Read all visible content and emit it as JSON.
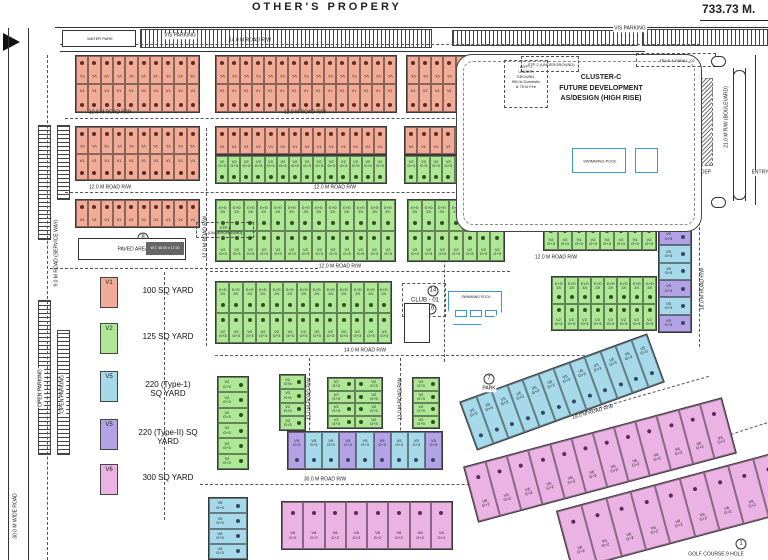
{
  "page": {
    "title": "OTHER'S PROPERY",
    "dimension": "733.73 M.",
    "water_park": "WATER PARK"
  },
  "legend": {
    "entries": [
      {
        "code": "V1",
        "color": "v1",
        "label": "100 SQ YARD"
      },
      {
        "code": "V2",
        "color": "v2",
        "label": "125 SQ YARD"
      },
      {
        "code": "V5",
        "color": "v5",
        "label": "220 (Type-1)|SQ YARD"
      },
      {
        "code": "V5",
        "color": "v5b",
        "label": "220 (Type-II) SQ|YARD"
      },
      {
        "code": "V6",
        "color": "v6",
        "label": "300 SQ YARD"
      }
    ]
  },
  "cluster_c": {
    "l1": "CLUSTER-C",
    "l2": "FUTURE DEVELOPMENT",
    "l3": "AS/DESIGN (HIGH RISE)",
    "stp2": "STP-2 (UNDERGROUND)",
    "trus": "TRUS & PANEL -02",
    "pool": "SWIMMING POOL"
  },
  "wtp1": {
    "l1": "WTP-1",
    "l2": "UNDER-",
    "l3": "GROUND,",
    "l4": "900 kl Domestic",
    "l5": "& 75 kl Fire"
  },
  "club": {
    "label": "CLUB - 01",
    "pool": "SWIMMING POOL"
  },
  "paved": {
    "label": "PAVED AREA",
    "stp1_l1": "STP-1",
    "stp1_l2": "(UNDERGROUND)",
    "tank_dim": "W.T. 48.00 x 17.00"
  },
  "colors": {
    "v1": "#f2ab97",
    "v2": "#aee795",
    "v5": "#a6d9e9",
    "v5b": "#b3a3e6",
    "v6": "#eab3e3",
    "dot_v1": "#5e2a22",
    "dot_v2": "#33511f",
    "dot_v5": "#35485c",
    "dot_v5b": "#43335e",
    "dot_v6": "#5c2c52",
    "line": "#333333",
    "pool": "#3f97c6"
  },
  "blocks": [
    {
      "x": 75,
      "y": 55,
      "w": 125,
      "h": 58,
      "c": "v1",
      "r": 2,
      "n": 10,
      "t": "V1",
      "d": "outer"
    },
    {
      "x": 215,
      "y": 55,
      "w": 182,
      "h": 58,
      "c": "v1",
      "r": 2,
      "n": 15,
      "t": "V1",
      "d": "outer"
    },
    {
      "x": 406,
      "y": 55,
      "w": 99,
      "h": 58,
      "c": "v1",
      "r": 2,
      "n": 8,
      "t": "V1",
      "d": "outer"
    },
    {
      "x": 75,
      "y": 126,
      "w": 125,
      "h": 55,
      "c": "v1",
      "r": 2,
      "n": 10,
      "t": "V1",
      "d": "outer"
    },
    {
      "x": 215,
      "y": 126,
      "w": 172,
      "h": 29,
      "c": "v1",
      "r": 1,
      "n": 14,
      "t": "V1",
      "d": "top"
    },
    {
      "x": 215,
      "y": 155,
      "w": 172,
      "h": 29,
      "c": "v2",
      "r": 1,
      "n": 14,
      "t": "V2 G+3",
      "d": "bottom"
    },
    {
      "x": 404,
      "y": 126,
      "w": 101,
      "h": 29,
      "c": "v1",
      "r": 1,
      "n": 8,
      "t": "V1",
      "d": "top"
    },
    {
      "x": 404,
      "y": 155,
      "w": 101,
      "h": 29,
      "c": "v2",
      "r": 1,
      "n": 8,
      "t": "V2 G+3",
      "d": "bottom"
    },
    {
      "x": 75,
      "y": 199,
      "w": 125,
      "h": 29,
      "c": "v1",
      "r": 1,
      "n": 10,
      "t": "V1",
      "d": "top"
    },
    {
      "x": 215,
      "y": 199,
      "w": 181,
      "h": 63,
      "c": "v2",
      "r": 2,
      "n": 13,
      "t": "V2 G+3",
      "d": "inner"
    },
    {
      "x": 407,
      "y": 199,
      "w": 98,
      "h": 63,
      "c": "v2",
      "r": 2,
      "n": 7,
      "t": "V2 G+3",
      "d": "inner"
    },
    {
      "x": 215,
      "y": 281,
      "w": 177,
      "h": 63,
      "c": "v2",
      "r": 2,
      "n": 13,
      "t": "V2 G+3",
      "d": "inner"
    },
    {
      "x": 543,
      "y": 224,
      "w": 114,
      "h": 27,
      "c": "v2",
      "r": 1,
      "n": 8,
      "t": "V2 G+3",
      "d": "top"
    },
    {
      "x": 551,
      "y": 276,
      "w": 106,
      "h": 55,
      "c": "v2",
      "r": 2,
      "n": 8,
      "t": "V2 G+3",
      "d": "inner"
    },
    {
      "x": 658,
      "y": 227,
      "w": 34,
      "h": 106,
      "c": "v5",
      "r": 6,
      "n": 1,
      "t": "V5 G+3",
      "d": "right",
      "cc": [
        "v5b",
        "v5",
        "v5",
        "v5b",
        "v5",
        "v5b"
      ]
    },
    {
      "x": 217,
      "y": 376,
      "w": 32,
      "h": 94,
      "c": "v2",
      "r": 6,
      "n": 1,
      "t": "V2 G+3",
      "d": "right"
    },
    {
      "x": 279,
      "y": 374,
      "w": 27,
      "h": 57,
      "c": "v2",
      "r": 4,
      "n": 1,
      "t": "V2 G+3",
      "d": "right"
    },
    {
      "x": 327,
      "y": 377,
      "w": 56,
      "h": 52,
      "c": "v2",
      "r": 4,
      "n": 2,
      "t": "V2 G+3",
      "d": "mid"
    },
    {
      "x": 412,
      "y": 377,
      "w": 28,
      "h": 52,
      "c": "v2",
      "r": 4,
      "n": 1,
      "t": "V2 G+3",
      "d": "right"
    },
    {
      "x": 287,
      "y": 431,
      "w": 156,
      "h": 39,
      "c": "v5",
      "r": 1,
      "n": 9,
      "t": "V5 G+3",
      "d": "bottom",
      "cc": [
        "v5b",
        "v5",
        "v5",
        "v5b",
        "v5",
        "v5b",
        "v5",
        "v5",
        "v5b"
      ]
    },
    {
      "x": 208,
      "y": 497,
      "w": 40,
      "h": 63,
      "c": "v5",
      "r": 4,
      "n": 1,
      "t": "V5 G+3",
      "d": "right"
    },
    {
      "x": 281,
      "y": 501,
      "w": 172,
      "h": 49,
      "c": "v6",
      "r": 1,
      "n": 8,
      "t": "V6 G+2",
      "d": "top"
    },
    {
      "x": 462,
      "y": 366,
      "w": 200,
      "h": 52,
      "c": "v5",
      "r": 1,
      "n": 12,
      "t": "V5 G+3",
      "d": "bottom",
      "rot": -20
    },
    {
      "x": 466,
      "y": 431,
      "w": 268,
      "h": 58,
      "c": "v6",
      "r": 1,
      "n": 12,
      "t": "V6 G+2",
      "d": "top",
      "rot": -15
    },
    {
      "x": 560,
      "y": 480,
      "w": 230,
      "h": 62,
      "c": "v6",
      "r": 1,
      "n": 9,
      "t": "V6 G+2",
      "d": "top",
      "rot": -15
    }
  ],
  "labels": [
    {
      "t": "14.0 M ROAD R/W",
      "x": 250,
      "y": 41,
      "rot": 0,
      "k": "road"
    },
    {
      "t": "12.0 M ROAD R/W",
      "x": 110,
      "y": 113,
      "rot": 0,
      "k": "road"
    },
    {
      "t": "12.0 M ROAD R/W",
      "x": 305,
      "y": 113,
      "rot": 0,
      "k": "road"
    },
    {
      "t": "12.0 M ROAD R/W",
      "x": 110,
      "y": 188,
      "rot": 0,
      "k": "road"
    },
    {
      "t": "12.0 M ROAD R/W",
      "x": 335,
      "y": 188,
      "rot": 0,
      "k": "road"
    },
    {
      "t": "12.0 M ROAD R/W",
      "x": 340,
      "y": 267,
      "rot": 0,
      "k": "road"
    },
    {
      "t": "14.0 M ROAD R/W",
      "x": 365,
      "y": 351,
      "rot": 0,
      "k": "road"
    },
    {
      "t": "16.0 M ROAD R/W",
      "x": 562,
      "y": 207,
      "rot": 0,
      "k": "road"
    },
    {
      "t": "12.0 M ROAD R/W",
      "x": 556,
      "y": 258,
      "rot": 0,
      "k": "road"
    },
    {
      "t": "30.0 M ROAD R/W",
      "x": 325,
      "y": 480,
      "rot": 0,
      "k": "road"
    },
    {
      "t": "12.0 M ROAD R/W",
      "x": 206,
      "y": 237,
      "rot": -90,
      "k": "road"
    },
    {
      "t": "12.0 M ROAD R/W",
      "x": 310,
      "y": 399,
      "rot": -90,
      "k": "road"
    },
    {
      "t": "12.0 M ROAD R/W",
      "x": 401,
      "y": 399,
      "rot": -90,
      "k": "road"
    },
    {
      "t": "18.0 M ROAD R/W",
      "x": 703,
      "y": 289,
      "rot": -90,
      "k": "road"
    },
    {
      "t": "18.0 M ROAD R/W",
      "x": 593,
      "y": 413,
      "rot": -16,
      "k": "road"
    },
    {
      "t": "9.0 M ROAD (SERVICE WAY)",
      "x": 57,
      "y": 253,
      "rot": -90,
      "k": "road"
    },
    {
      "t": "21.0 M R/W (BOULEVARD)",
      "x": 727,
      "y": 117,
      "rot": -90,
      "k": "road"
    },
    {
      "t": "OPEN PARKING",
      "x": 41,
      "y": 388,
      "rot": -90,
      "k": "area"
    },
    {
      "t": "OPEN PARKING",
      "x": 63,
      "y": 394,
      "rot": -90,
      "k": "area"
    },
    {
      "t": "30.0 M WIDE ROAD",
      "x": 16,
      "y": 516,
      "rot": -90,
      "k": "road"
    },
    {
      "t": "VIS PARKING",
      "x": 180,
      "y": 36,
      "rot": 0,
      "k": "area"
    },
    {
      "t": "VIS PARKING",
      "x": 630,
      "y": 29,
      "rot": 0,
      "k": "area"
    },
    {
      "t": "DEP",
      "x": 706,
      "y": 173,
      "rot": 0,
      "k": "area"
    },
    {
      "t": "ENTRY",
      "x": 760,
      "y": 173,
      "rot": 0,
      "k": "area"
    },
    {
      "t": "PARK",
      "x": 489,
      "y": 389,
      "rot": 0,
      "k": "area"
    },
    {
      "t": "GOLF COURSE 9 HOLE",
      "x": 716,
      "y": 555,
      "rot": 0,
      "k": "area"
    }
  ],
  "badges": [
    {
      "n": "8",
      "x": 143,
      "y": 238
    },
    {
      "n": "14",
      "x": 433,
      "y": 291
    },
    {
      "n": "16",
      "x": 431,
      "y": 309
    },
    {
      "n": "13",
      "x": 410,
      "y": 318
    },
    {
      "n": "7",
      "x": 489,
      "y": 379
    },
    {
      "n": "1",
      "x": 741,
      "y": 544
    }
  ],
  "dashes": [
    {
      "x": 60,
      "y": 44,
      "w": 640,
      "rot": 0
    },
    {
      "x": 65,
      "y": 118,
      "w": 445,
      "rot": 0
    },
    {
      "x": 65,
      "y": 192,
      "w": 445,
      "rot": 0
    },
    {
      "x": 210,
      "y": 271,
      "w": 300,
      "rot": 0
    },
    {
      "x": 215,
      "y": 355,
      "w": 430,
      "rot": 0
    },
    {
      "x": 200,
      "y": 484,
      "w": 340,
      "rot": 0
    },
    {
      "x": 207,
      "y": 128,
      "w": 218,
      "rot": 90
    },
    {
      "x": 310,
      "y": 358,
      "w": 112,
      "rot": 90
    },
    {
      "x": 401,
      "y": 358,
      "w": 112,
      "rot": 90
    },
    {
      "x": 445,
      "y": 200,
      "w": 162,
      "rot": 90
    },
    {
      "x": 700,
      "y": 212,
      "w": 135,
      "rot": 90
    },
    {
      "x": 48,
      "y": 55,
      "w": 505,
      "rot": 90
    },
    {
      "x": 50,
      "y": 268,
      "w": 268,
      "rot": 0
    },
    {
      "x": 165,
      "y": 272,
      "w": 248,
      "rot": 90
    },
    {
      "x": 478,
      "y": 442,
      "w": 240,
      "rot": -16
    },
    {
      "x": 585,
      "y": 520,
      "w": 225,
      "rot": -16
    },
    {
      "x": 620,
      "y": 470,
      "w": 200,
      "rot": -18
    }
  ],
  "hatches": [
    {
      "x": 140,
      "y": 29,
      "w": 292,
      "h": 19,
      "d": "v"
    },
    {
      "x": 452,
      "y": 30,
      "w": 186,
      "h": 16,
      "d": "v"
    },
    {
      "x": 642,
      "y": 29,
      "w": 126,
      "h": 17,
      "d": "v"
    },
    {
      "x": 38,
      "y": 125,
      "w": 13,
      "h": 115,
      "d": "h"
    },
    {
      "x": 57,
      "y": 125,
      "w": 13,
      "h": 75,
      "d": "h"
    },
    {
      "x": 38,
      "y": 300,
      "w": 13,
      "h": 155,
      "d": "h"
    },
    {
      "x": 57,
      "y": 330,
      "w": 13,
      "h": 125,
      "d": "h"
    },
    {
      "x": 652,
      "y": 78,
      "w": 13,
      "h": 88,
      "d": "d"
    },
    {
      "x": 700,
      "y": 78,
      "w": 13,
      "h": 88,
      "d": "d"
    }
  ],
  "lines": [
    {
      "x": 55,
      "y": 27,
      "w": 713,
      "h": 1
    },
    {
      "x": 60,
      "y": 51,
      "w": 585,
      "h": 1
    },
    {
      "x": 8,
      "y": 28,
      "w": 1,
      "h": 532
    },
    {
      "x": 28,
      "y": 28,
      "w": 1,
      "h": 532
    },
    {
      "x": 733,
      "y": 68,
      "w": 1,
      "h": 133
    },
    {
      "x": 745,
      "y": 68,
      "w": 1,
      "h": 133
    },
    {
      "x": 755,
      "y": 55,
      "w": 1,
      "h": 150
    }
  ],
  "legend_layout": {
    "ys": [
      277,
      323,
      371,
      419,
      464
    ]
  }
}
